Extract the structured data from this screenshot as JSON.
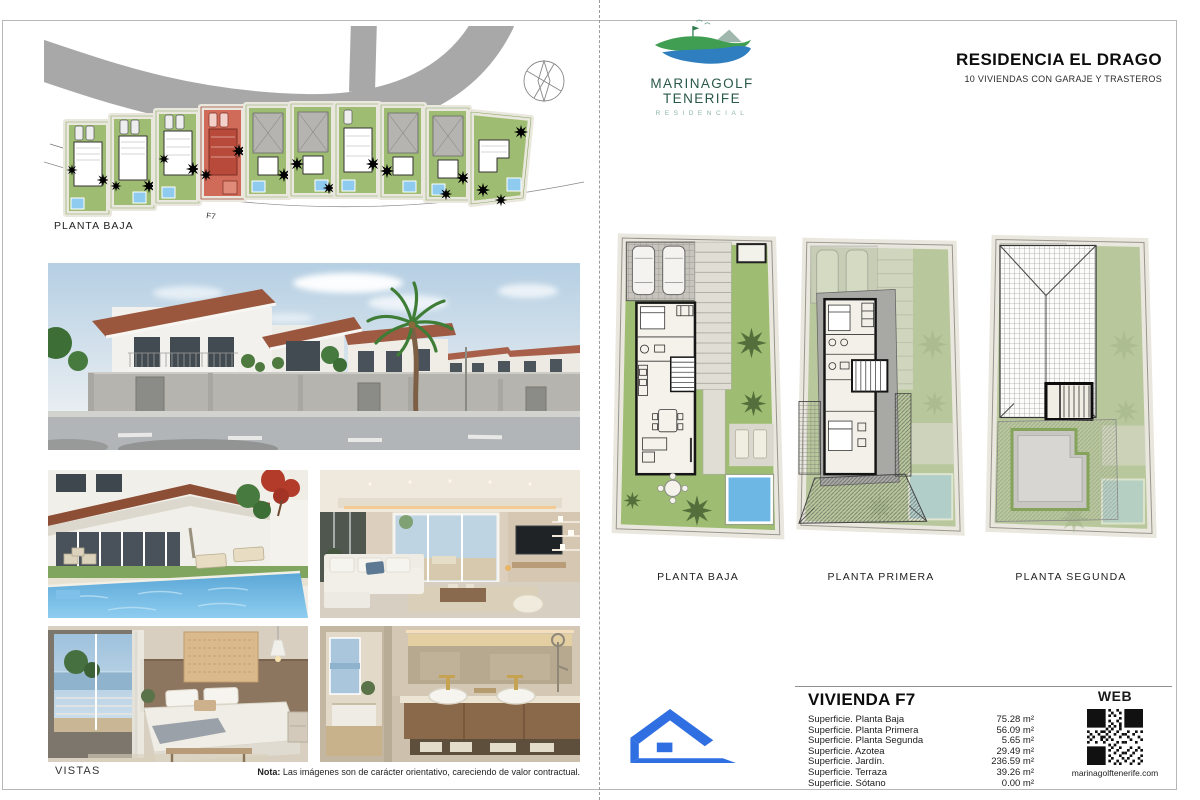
{
  "left_page": {
    "site_plan": {
      "label": "PLANTA BAJA",
      "unit_marker": "F7"
    },
    "vistas_label": "VISTAS",
    "note": {
      "bold": "Nota:",
      "text": " Las imágenes son de carácter orientativo, careciendo de valor contractual."
    }
  },
  "right_page": {
    "logo": {
      "title": "MARINAGOLF TENERIFE",
      "subtitle": "RESIDENCIAL"
    },
    "header": {
      "title": "RESIDENCIA EL DRAGO",
      "subtitle": "10 VIVIENDAS CON GARAJE Y TRASTEROS"
    },
    "floorplans": [
      {
        "label": "PLANTA BAJA"
      },
      {
        "label": "PLANTA PRIMERA"
      },
      {
        "label": "PLANTA SEGUNDA"
      }
    ],
    "unit_info": {
      "title": "VIVIENDA F7",
      "surfaces": [
        {
          "label": "Superficie. Planta Baja",
          "value": "75.28 m²"
        },
        {
          "label": "Superficie. Planta Primera",
          "value": "56.09 m²"
        },
        {
          "label": "Superficie. Planta Segunda",
          "value": "5.65 m²"
        },
        {
          "label": "Superficie. Azotea",
          "value": "29.49 m²"
        },
        {
          "label": "Superficie. Jardín.",
          "value": "236.59 m²"
        },
        {
          "label": "Superficie. Terraza",
          "value": "39.26 m²"
        },
        {
          "label": "Superficie. Sótano",
          "value": "0.00 m²"
        }
      ]
    },
    "web": {
      "title": "WEB",
      "url": "marinagolftenerife.com"
    }
  },
  "colors": {
    "accent_blue": "#2f6fe2",
    "logo_green": "#3f9e52",
    "logo_blue": "#2f7ec0",
    "plan_green": "#9fbd72",
    "pool_blue": "#6db7e4",
    "highlight_red": "#c9594a",
    "road_gray": "#a8a8a8"
  }
}
